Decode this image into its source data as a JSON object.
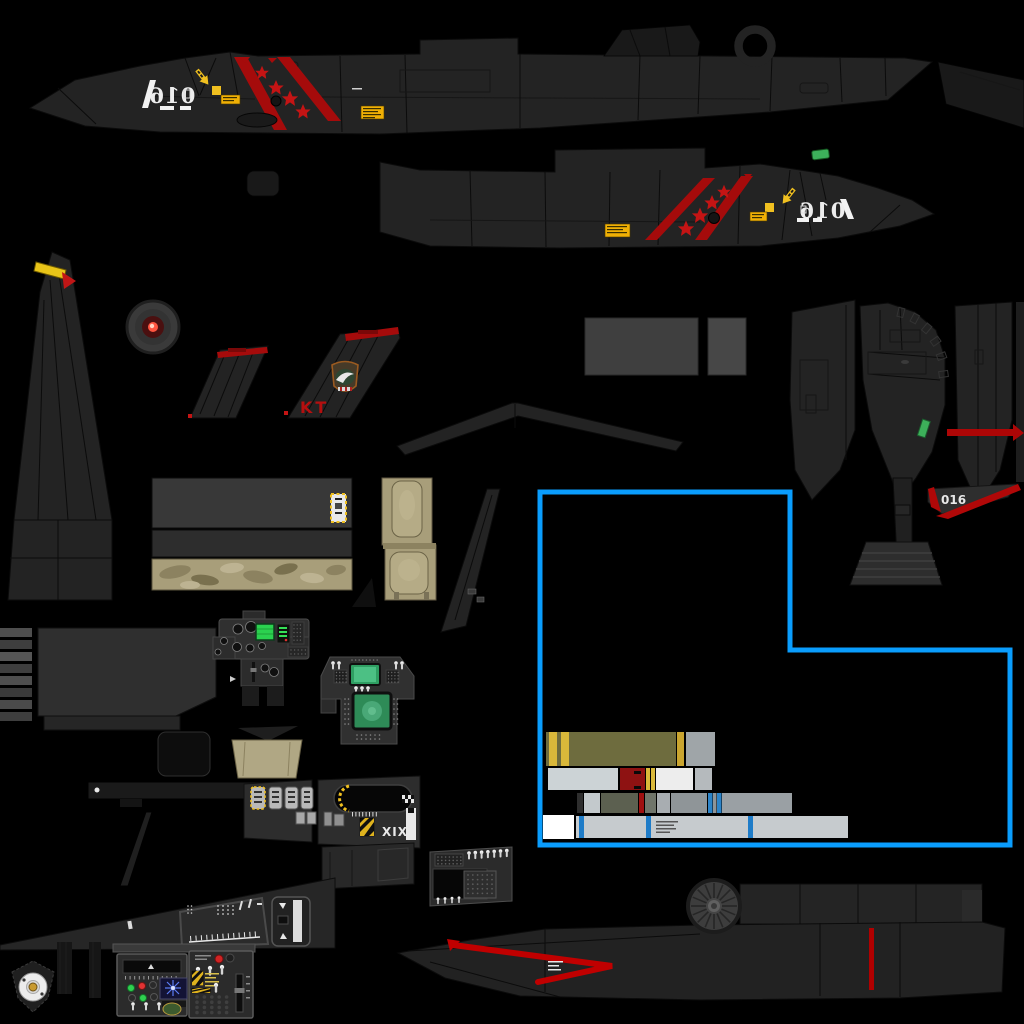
{
  "meta": {
    "kind": "aircraft livery texture atlas",
    "canvas": {
      "width": 1024,
      "height": 1024
    }
  },
  "markings": {
    "board_number": "016",
    "tail_code": "KT",
    "gear_door_number": "016",
    "seat_console_numeral": "XIX"
  },
  "decals": {
    "kill_stars_per_side": 4,
    "victory_stripes_per_side": 2,
    "rescue_arrow_color": "#f5c11e",
    "selection_outline": "uv-island-highlight"
  },
  "palette": {
    "background": "#000000",
    "airframe": "#232323",
    "airframe_dark": "#191919",
    "airframe_light": "#2f2f2f",
    "panel_line": "#0b0b0b",
    "stripe_red": "#a50b0b",
    "star_red": "#c41414",
    "decal_yellow": "#f0c020",
    "placard_yellow": "#f0b005",
    "selection_blue": "#0a9dfd",
    "formation_green": "#3db05a",
    "crt_green": "#2bd14f",
    "mfd_green": "#2e8b57",
    "seat_tan": "#a89e7a",
    "missile_olive": "#6e6c3e",
    "missile_gold": "#d9b83a",
    "steel_gray": "#c3c9cc",
    "white": "#f2f2f2",
    "wheel_amber": "#c89a30",
    "compass_blue": "#5b7df5",
    "fire_handle_red": "#c92020"
  }
}
